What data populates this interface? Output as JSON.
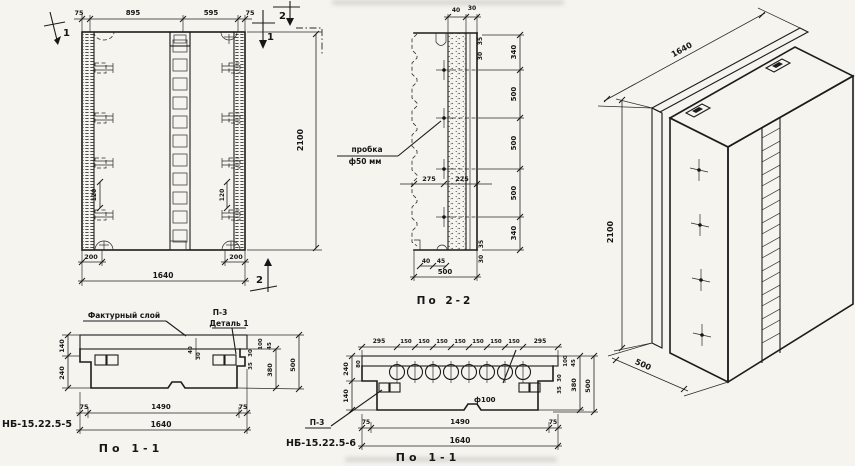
{
  "front": {
    "top_dims": [
      "75",
      "895",
      "595",
      "75"
    ],
    "bottom_dims_small": [
      "200",
      "200"
    ],
    "bottom_total": "1640",
    "height": "2100",
    "pitch_left": "120",
    "pitch_right": "120",
    "markers": {
      "m1a": "1",
      "m1b": "1",
      "m2a": "2",
      "m2b": "2"
    }
  },
  "section22": {
    "caption": "По 2-2",
    "plug_line1": "пробка",
    "plug_line2": "ф50 мм",
    "top_dims": [
      "40",
      "30"
    ],
    "top_side_dims": [
      "35",
      "30"
    ],
    "right_dims": [
      "340",
      "500",
      "500",
      "500",
      "340"
    ],
    "mid_dims": [
      "275",
      "225"
    ],
    "bottom_side_dims": [
      "35",
      "30"
    ],
    "bottom_dims": [
      "40",
      "45"
    ],
    "bottom_total": "500"
  },
  "axon": {
    "length": "1640",
    "height": "2100",
    "depth": "500"
  },
  "plan5": {
    "title": "НБ-15.22.5-5",
    "caption": "По 1-1",
    "facing_label": "Фактурный слой",
    "p3_label": "П-3",
    "detail_label": "Деталь 1",
    "left_dims": [
      "140",
      "240"
    ],
    "layer_dims": [
      "40",
      "30"
    ],
    "end_dims": [
      "30",
      "35"
    ],
    "right_small_dims": [
      "100",
      "45"
    ],
    "right_dims": [
      "380",
      "500"
    ],
    "bottom_dims": [
      "75",
      "1490",
      "75"
    ],
    "bottom_total": "1640"
  },
  "plan6": {
    "title": "НБ-15.22.5-6",
    "caption": "По 1-1",
    "p3_label": "П-3",
    "hole_label": "ф100",
    "top_dims": [
      "295",
      "150",
      "150",
      "150",
      "150",
      "150",
      "150",
      "150",
      "295"
    ],
    "left_dims": [
      "240",
      "140"
    ],
    "left_small": "80",
    "end_dims": [
      "30",
      "35"
    ],
    "right_small_dims": [
      "100",
      "45"
    ],
    "right_dims": [
      "380",
      "500"
    ],
    "bottom_dims": [
      "75",
      "1490",
      "75"
    ],
    "bottom_total": "1640"
  }
}
